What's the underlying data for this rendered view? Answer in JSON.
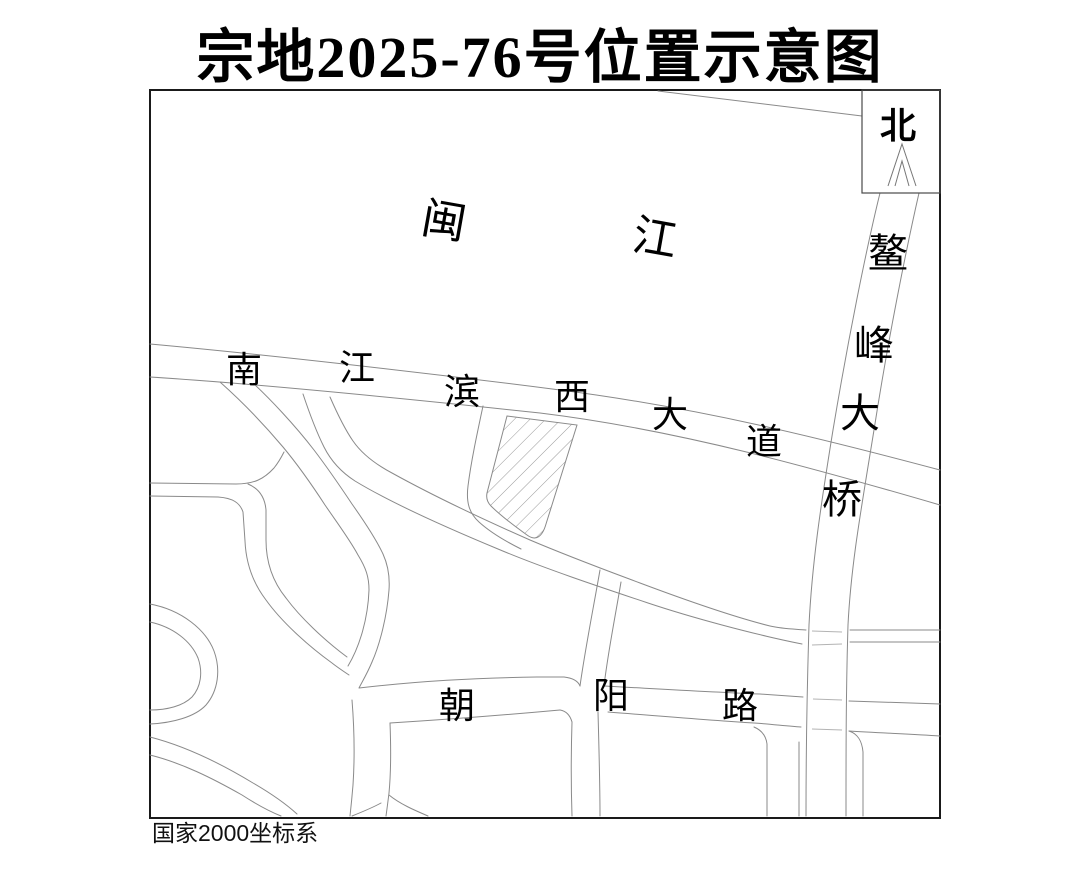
{
  "title": "宗地2025-76号位置示意图",
  "footnote": "国家2000坐标系",
  "map": {
    "north_indicator": {
      "label": "北"
    },
    "river": {
      "name": "闽江",
      "chars": [
        "闽",
        "江"
      ]
    },
    "roads": {
      "riverside_avenue": {
        "name": "南江滨西大道",
        "chars": [
          "南",
          "江",
          "滨",
          "西",
          "大",
          "道"
        ]
      },
      "aofeng_bridge": {
        "name": "鳌峰大桥",
        "chars": [
          "鳌",
          "峰",
          "大",
          "桥"
        ]
      },
      "chaoyang_road": {
        "name": "朝阳路",
        "chars": [
          "朝",
          "阳",
          "路"
        ]
      }
    },
    "parcel": {
      "style": "hatched",
      "outline": "polygon"
    }
  },
  "colors": {
    "background": "#ffffff",
    "frame": "#1a1a1a",
    "road_line": "#8a8a8a",
    "hatch": "#999999",
    "text": "#000000"
  }
}
